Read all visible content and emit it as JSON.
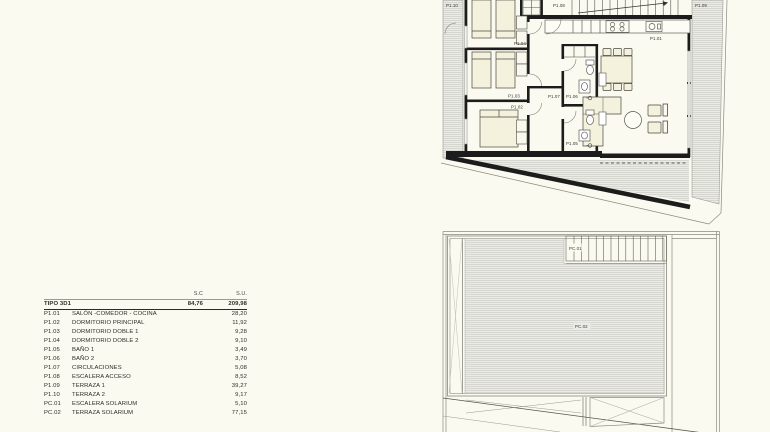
{
  "colors": {
    "background": "#fafaf0",
    "wall": "#1c1c1c",
    "hatch_fill": "#ebebe7",
    "hatch_line": "#c8c8c2",
    "furniture_fill": "#f4f1dc",
    "thin_line": "#8a8a82",
    "text": "#2e2e2a"
  },
  "area_table": {
    "col_headers": {
      "sc": "S.C",
      "su": "S.U."
    },
    "tipo": {
      "name": "TIPO 3D1",
      "sc": "84,76",
      "su": "209,98"
    },
    "items": [
      {
        "code": "P1.01",
        "name": "SALÓN -COMEDOR - COCINA",
        "su": "28,20"
      },
      {
        "code": "P1.02",
        "name": "DORMITORIO PRINCIPAL",
        "su": "11,92"
      },
      {
        "code": "P1.03",
        "name": "DORMITORIO DOBLE 1",
        "su": "9,28"
      },
      {
        "code": "P1.04",
        "name": "DORMITORIO DOBLE 2",
        "su": "9,10"
      },
      {
        "code": "P1.05",
        "name": "BAÑO 1",
        "su": "3,49"
      },
      {
        "code": "P1.06",
        "name": "BAÑO 2",
        "su": "3,70"
      },
      {
        "code": "P1.07",
        "name": "CIRCULACIONES",
        "su": "5,08"
      },
      {
        "code": "P1.08",
        "name": "ESCALERA ACCESO",
        "su": "8,52"
      },
      {
        "code": "P1.09",
        "name": "TERRAZA 1",
        "su": "39,27"
      },
      {
        "code": "P1.10",
        "name": "TERRAZA 2",
        "su": "9,17"
      },
      {
        "code": "PC.01",
        "name": "ESCALERA SOLARIUM",
        "su": "5,10"
      },
      {
        "code": "PC.02",
        "name": "TERRAZA SOLARIUM",
        "su": "77,15"
      }
    ]
  },
  "floor_plan": {
    "labels": {
      "p101": "P1.01",
      "p102": "P1.02",
      "p103": "P1.03",
      "p104": "P1.04",
      "p105": "P1.05",
      "p106": "P1.06",
      "p107": "P1.07",
      "p108": "P1.08",
      "p109": "P1.09",
      "p110": "P1.10"
    }
  },
  "solarium_plan": {
    "labels": {
      "pc01": "PC.01",
      "pc02": "PC.02"
    }
  }
}
